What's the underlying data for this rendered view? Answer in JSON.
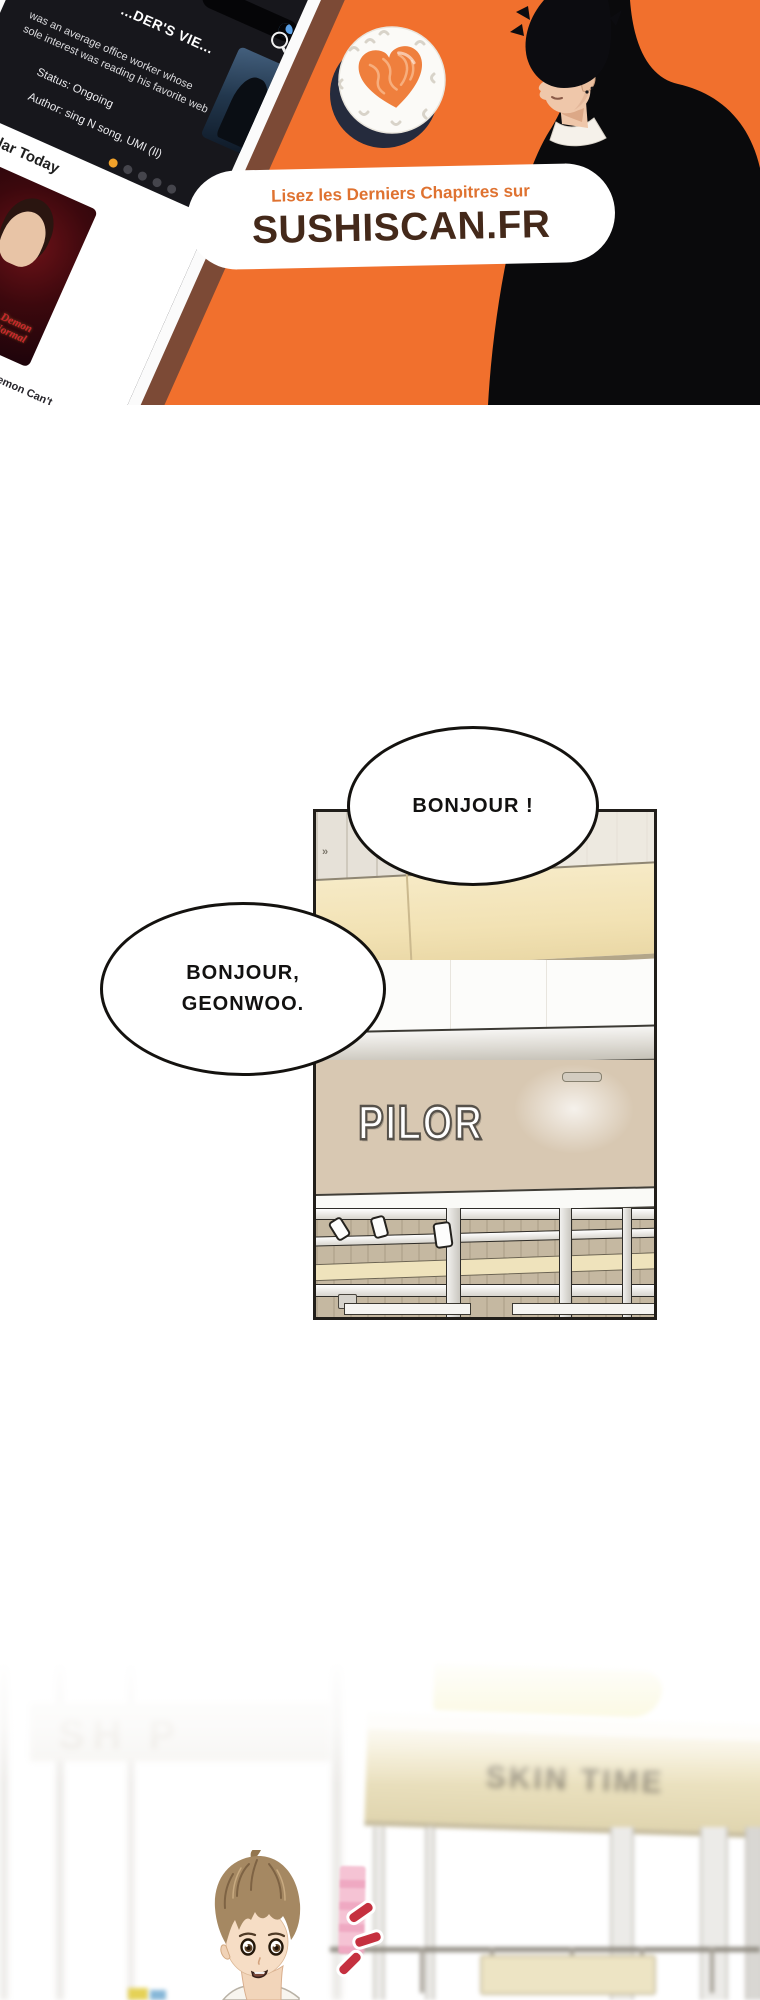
{
  "ad_banner": {
    "background_color": "#F1702D",
    "tagline": "Lisez les Derniers Chapitres sur",
    "site_name": "SUSHISCAN.FR",
    "tagline_color": "#DF7230",
    "site_name_color": "#44291A",
    "phone_app": {
      "hero_title": "...DER'S VIE...",
      "hero_description_line1": "was an average office worker whose",
      "hero_description_line2": "sole interest was reading his favorite web",
      "hero_status": "Status: Ongoing",
      "hero_author": "Author: sing N song, UMI (Il)",
      "section_heading": "Popular Today",
      "badge": "MANHWA",
      "cover_title_art": "the Heavenly Demon Can't Live a Normal Life",
      "caption_line1": "e Heavenly Demon Can't",
      "caption_line2": "a Normal Life",
      "rating": "9.7",
      "star": "★",
      "carousel_dots_total": 5,
      "carousel_active_dot": 1
    }
  },
  "comic": {
    "panel1": {
      "speech_bubble_1": "BONJOUR !",
      "speech_bubble_2_line1": "BONJOUR,",
      "speech_bubble_2_line2": "GEONWOO.",
      "storefront_sign": "PILOR",
      "wall_mark": "»"
    },
    "panel2": {
      "left_store_sign": "SH P",
      "store_sign_blurred": "SKIN TIME"
    }
  }
}
